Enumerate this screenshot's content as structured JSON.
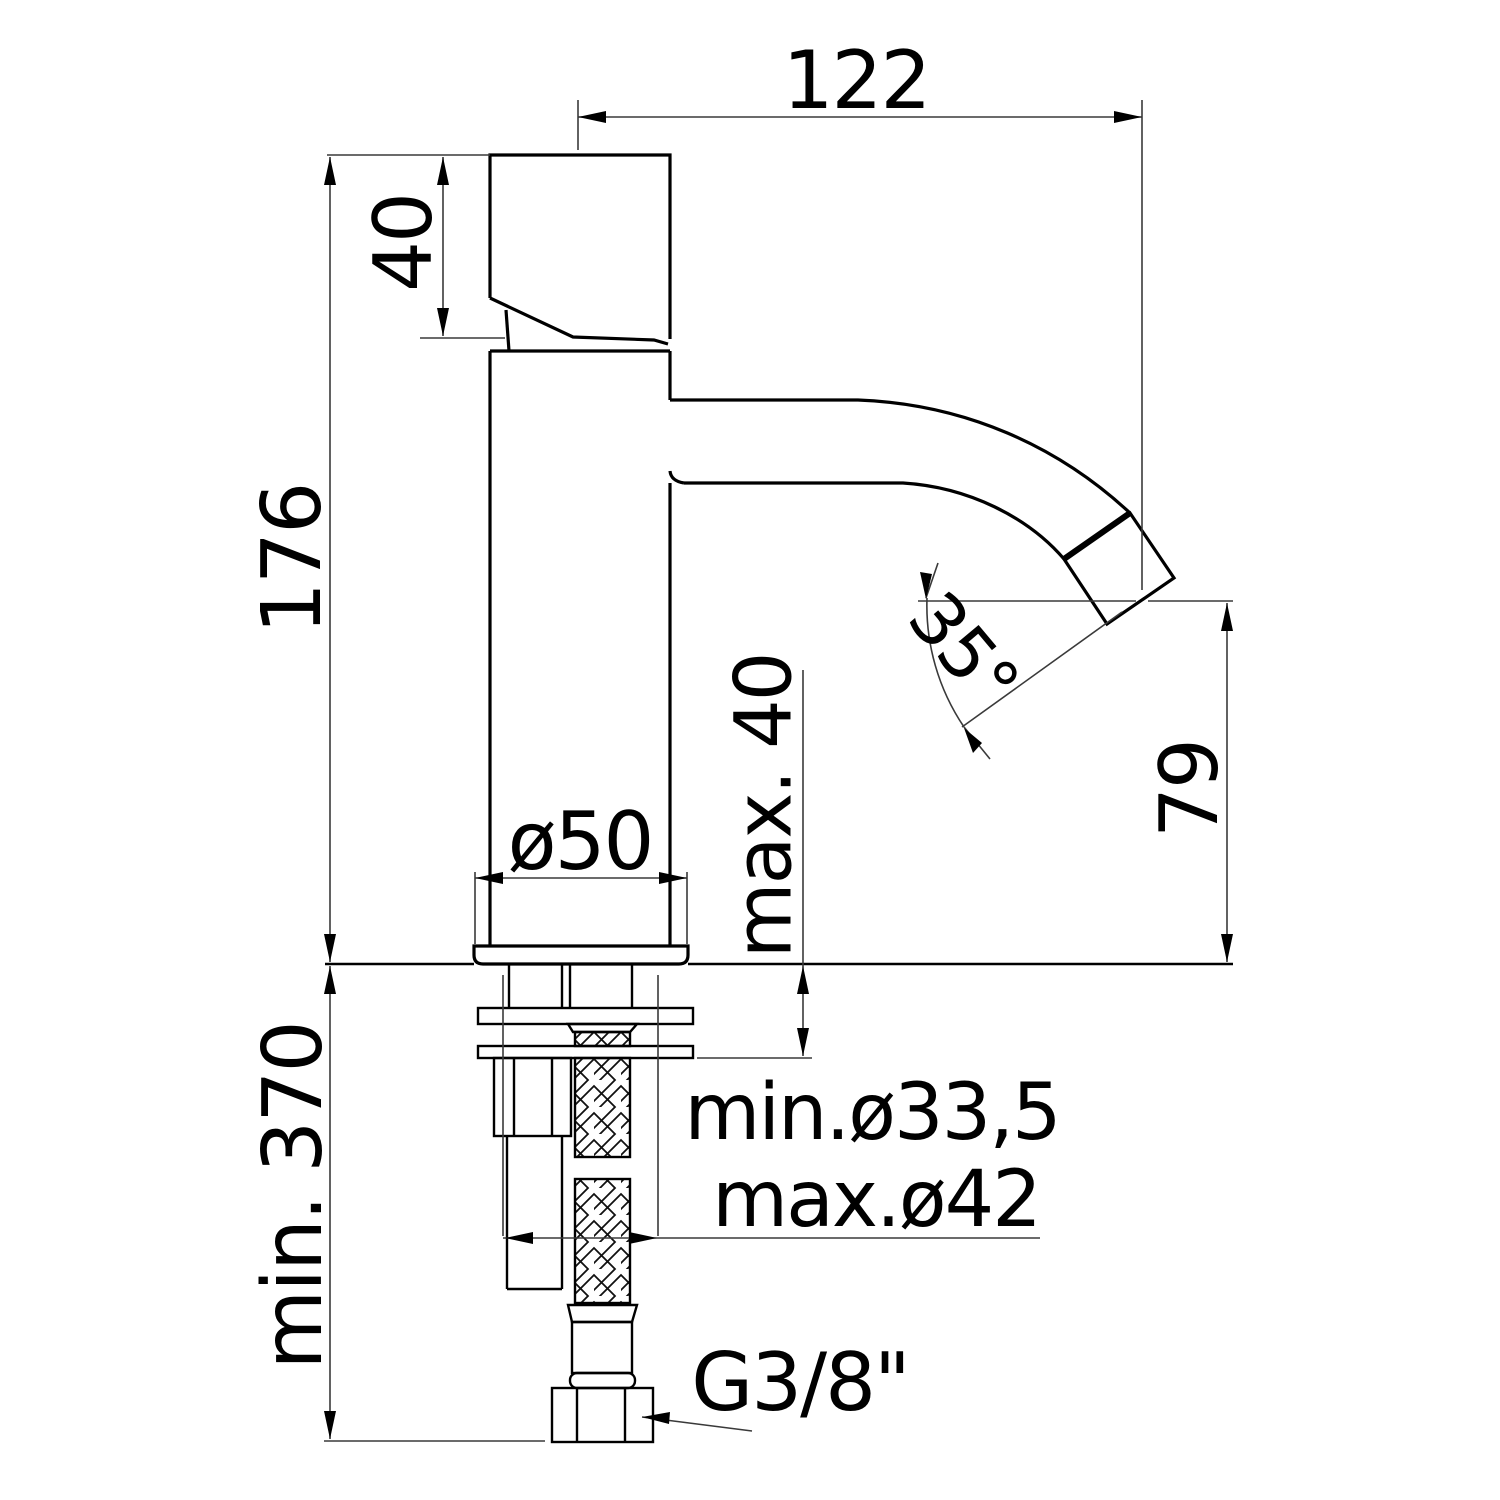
{
  "drawing": {
    "type": "technical dimensional drawing",
    "subject": "single-lever basin faucet, side elevation with installation dimensions",
    "colors": {
      "line": "#000000",
      "background": "#ffffff"
    },
    "labels": {
      "spout_reach": "122",
      "handle_height": "40",
      "total_height": "176",
      "base_diameter": "ø50",
      "deck_max_thickness": "max. 40",
      "spout_angle": "35°",
      "spout_outlet_height": "79",
      "min_space_below": "min. 370",
      "hole_min_diameter": "min.ø33,5",
      "hole_max_diameter": "max.ø42",
      "supply_connection": "G3/8\""
    }
  }
}
